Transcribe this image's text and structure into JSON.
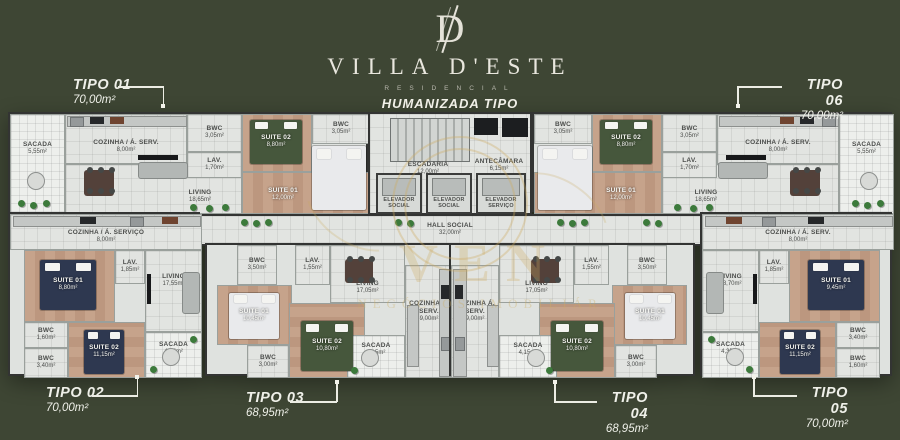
{
  "colors": {
    "background": "#3e4634",
    "accent_gold": "#c9a45c",
    "floor_tile": "#e2e4e1",
    "floor_wood": "#c2a089",
    "bed_green": "#46573c",
    "bed_navy": "#2e3850",
    "text_light": "#eff0e9"
  },
  "header": {
    "monogram": "D",
    "title": "VILLA D'ESTE",
    "subtitle": "RESIDENCIAL",
    "plan_title": "HUMANIZADA TIPO"
  },
  "watermark": {
    "big_text": "VEN",
    "small_text": "NEGÓCIOS IMOBILIÁR"
  },
  "callouts": {
    "tipo01": {
      "name": "TIPO 01",
      "area": "70,00m²"
    },
    "tipo02": {
      "name": "TIPO 02",
      "area": "70,00m²"
    },
    "tipo03": {
      "name": "TIPO 03",
      "area": "68,95m²"
    },
    "tipo04": {
      "name": "TIPO 04",
      "area": "68,95m²"
    },
    "tipo05": {
      "name": "TIPO 05",
      "area": "70,00m²"
    },
    "tipo06": {
      "name": "TIPO 06",
      "area": "70,00m²"
    }
  },
  "core": {
    "escadaria": {
      "label": "ESCADARIA",
      "area": "12,00m²"
    },
    "antecamara": {
      "label": "ANTECÂMARA",
      "area": "6,15m²"
    },
    "elevator1": {
      "label": "ELEVADOR SOCIAL"
    },
    "elevator2": {
      "label": "ELEVADOR SOCIAL"
    },
    "elevator3": {
      "label": "ELEVADOR SERVIÇO"
    },
    "hall": {
      "label": "HALL SOCIAL",
      "area": "32,00m²"
    }
  },
  "units": {
    "t1": {
      "sacada": {
        "label": "SACADA",
        "area": "5,55m²"
      },
      "cozinha": {
        "label": "COZINHA / Á. SERV.",
        "area": "8,00m²"
      },
      "bwc1": {
        "label": "BWC",
        "area": "3,05m²"
      },
      "lav": {
        "label": "LAV.",
        "area": "1,70m²"
      },
      "living": {
        "label": "LIVING",
        "area": "18,65m²"
      },
      "suite2": {
        "label": "SUITE 02",
        "area": "8,80m²"
      },
      "bwc2": {
        "label": "BWC",
        "area": "3,05m²"
      },
      "suite1": {
        "label": "SUITE 01",
        "area": "12,00m²"
      }
    },
    "t6": {
      "sacada": {
        "label": "SACADA",
        "area": "5,55m²"
      },
      "cozinha": {
        "label": "COZINHA / Á. SERV.",
        "area": "8,00m²"
      },
      "bwc1": {
        "label": "BWC",
        "area": "3,05m²"
      },
      "lav": {
        "label": "LAV.",
        "area": "1,70m²"
      },
      "living": {
        "label": "LIVING",
        "area": "18,65m²"
      },
      "suite2": {
        "label": "SUITE 02",
        "area": "8,80m²"
      },
      "bwc2": {
        "label": "BWC",
        "area": "3,05m²"
      },
      "suite1": {
        "label": "SUITE 01",
        "area": "12,00m²"
      }
    },
    "t2": {
      "cozinha": {
        "label": "COZINHA / Á. SERVIÇO",
        "area": "8,00m²"
      },
      "suite1": {
        "label": "SUITE 01",
        "area": "8,80m²"
      },
      "lav": {
        "label": "LAV.",
        "area": "1,85m²"
      },
      "living": {
        "label": "LIVING",
        "area": "17,55m²"
      },
      "bwc1": {
        "label": "BWC",
        "area": "1,60m²"
      },
      "bwc2": {
        "label": "BWC",
        "area": "3,40m²"
      },
      "suite2": {
        "label": "SUITE 02",
        "area": "11,15m²"
      },
      "sacada": {
        "label": "SACADA",
        "area": "4,35m²"
      }
    },
    "t5": {
      "cozinha": {
        "label": "COZINHA / Á. SERV.",
        "area": "8,00m²"
      },
      "living": {
        "label": "LIVING",
        "area": "18,70m²"
      },
      "lav": {
        "label": "LAV.",
        "area": "1,85m²"
      },
      "suite1": {
        "label": "SUITE 01",
        "area": "9,45m²"
      },
      "bwc1": {
        "label": "BWC",
        "area": "3,40m²"
      },
      "suite2": {
        "label": "SUITE 02",
        "area": "11,15m²"
      },
      "bwc2": {
        "label": "BWC",
        "area": "1,60m²"
      },
      "sacada": {
        "label": "SACADA",
        "area": "4,35m²"
      }
    },
    "t3": {
      "bwc1": {
        "label": "BWC",
        "area": "3,50m²"
      },
      "lav": {
        "label": "LAV.",
        "area": "1,55m²"
      },
      "suite1": {
        "label": "SUITE 01",
        "area": "10,45m²"
      },
      "bwc2": {
        "label": "BWC",
        "area": "3,00m²"
      },
      "suite2": {
        "label": "SUITE 02",
        "area": "10,80m²"
      },
      "living": {
        "label": "LIVING",
        "area": "17,05m²"
      },
      "cozinha": {
        "label": "COZINHA Á. SERV.",
        "area": "9,00m²"
      },
      "sacada": {
        "label": "SACADA",
        "area": "4,15m²"
      }
    },
    "t4": {
      "bwc1": {
        "label": "BWC",
        "area": "3,50m²"
      },
      "lav": {
        "label": "LAV.",
        "area": "1,55m²"
      },
      "suite1": {
        "label": "SUITE 01",
        "area": "10,45m²"
      },
      "bwc2": {
        "label": "BWC",
        "area": "3,00m²"
      },
      "suite2": {
        "label": "SUITE 02",
        "area": "10,80m²"
      },
      "living": {
        "label": "LIVING",
        "area": "17,05m²"
      },
      "cozinha": {
        "label": "COZINHA Á. SERV.",
        "area": "9,00m²"
      },
      "sacada": {
        "label": "SACADA",
        "area": "4,15m²"
      }
    }
  }
}
